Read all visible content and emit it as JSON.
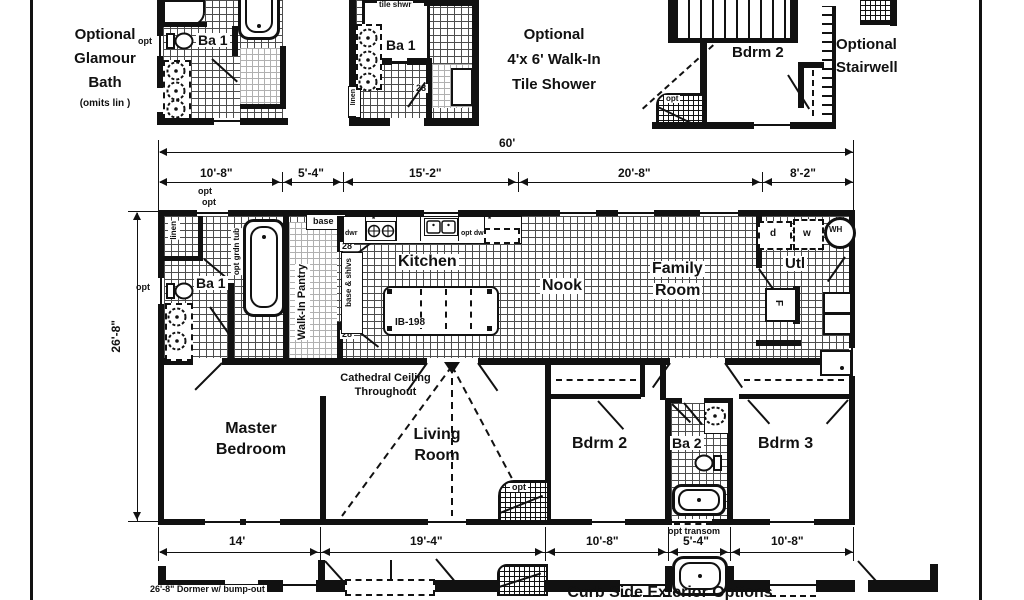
{
  "options": {
    "glamour": {
      "l1": "Optional",
      "l2": "Glamour",
      "l3": "Bath",
      "note": "(omits lin )",
      "room": "Ba 1"
    },
    "shower": {
      "l1": "Optional",
      "l2": "4'x 6' Walk-In",
      "l3": "Tile Shower",
      "room": "Ba 1",
      "shwr": "tile shwr"
    },
    "stair": {
      "l1": "Optional",
      "l2": "Stairwell",
      "room": "Bdrm 2"
    }
  },
  "dims": {
    "total": "60'",
    "top": [
      "10'-8\"",
      "5'-4\"",
      "15'-2\"",
      "20'-8\"",
      "8'-2\""
    ],
    "left": "26'-8\"",
    "bottom": [
      "14'",
      "19'-4\"",
      "10'-8\"",
      "5'-4\"",
      "10'-8\""
    ]
  },
  "rooms": {
    "ba1": "Ba 1",
    "kitchen": "Kitchen",
    "nook": "Nook",
    "family1": "Family",
    "family2": "Room",
    "utl": "Utl",
    "master1": "Master",
    "master2": "Bedroom",
    "living1": "Living",
    "living2": "Room",
    "bdrm2": "Bdrm 2",
    "ba2": "Ba 2",
    "bdrm3": "Bdrm 3"
  },
  "labels": {
    "opt": "opt",
    "linen": "linen",
    "grdntub": "opt grdn tub",
    "base": "base",
    "dwr": "dwr",
    "optdw": "opt dw",
    "star": "*",
    "pantry": "Walk-In Pantry",
    "baseshlvs": "base & shlvs",
    "d28": "28",
    "island": "IB-198",
    "cath1": "Cathedral Ceiling",
    "cath2": "Throughout",
    "opttransom": "opt transom",
    "d": "d",
    "w": "w",
    "wh": "WH",
    "f": "F"
  },
  "bottom": {
    "dormer": "26'-8\" Dormer w/ bump-out",
    "curb": "Curb Side Exterior Options"
  }
}
